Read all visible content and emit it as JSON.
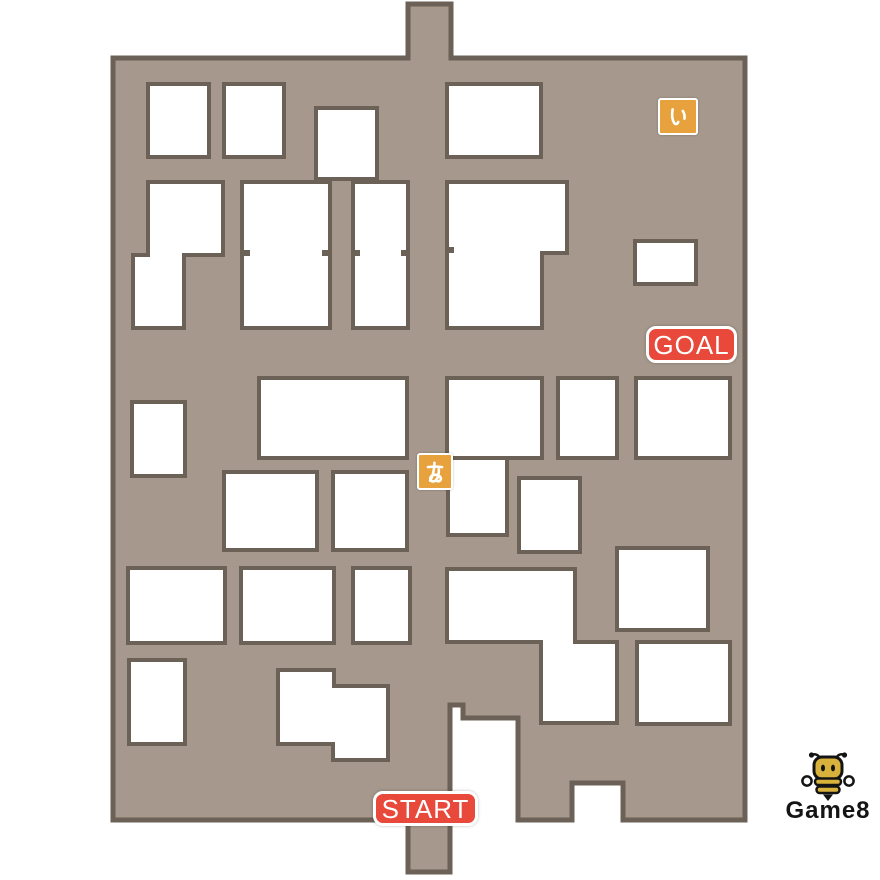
{
  "map": {
    "colors": {
      "ground": "#a6988c",
      "outline": "#6b6156",
      "building": "#ffffff",
      "background": "#ffffff"
    },
    "outer_stroke": 5,
    "building_stroke": 4,
    "outer_outline": "113,58 408,58 408,4 451,4 451,58 745,58 745,820 623,820 623,783 572,783 572,820 518,820 518,718 463,718 463,705 450,705 450,872 408,872 408,820 113,820",
    "buildings": [
      {
        "x": 148,
        "y": 84,
        "w": 61,
        "h": 73
      },
      {
        "x": 224,
        "y": 84,
        "w": 60,
        "h": 73
      },
      {
        "x": 316,
        "y": 108,
        "w": 61,
        "h": 71
      },
      {
        "x": 447,
        "y": 84,
        "w": 94,
        "h": 73
      },
      {
        "points": "148,182 223,182 223,255 184,255 184,328 133,328 133,255 148,255"
      },
      {
        "x": 242,
        "y": 182,
        "w": 88,
        "h": 146
      },
      {
        "x": 353,
        "y": 182,
        "w": 55,
        "h": 146
      },
      {
        "points": "447,182 567,182 567,253 542,253 542,328 447,328"
      },
      {
        "x": 635,
        "y": 241,
        "w": 61,
        "h": 43
      },
      {
        "x": 132,
        "y": 402,
        "w": 53,
        "h": 74
      },
      {
        "x": 259,
        "y": 378,
        "w": 148,
        "h": 80
      },
      {
        "x": 447,
        "y": 378,
        "w": 95,
        "h": 80
      },
      {
        "x": 558,
        "y": 378,
        "w": 59,
        "h": 80
      },
      {
        "x": 636,
        "y": 378,
        "w": 94,
        "h": 80
      },
      {
        "x": 448,
        "y": 458,
        "w": 59,
        "h": 77
      },
      {
        "x": 224,
        "y": 472,
        "w": 93,
        "h": 78
      },
      {
        "x": 333,
        "y": 472,
        "w": 74,
        "h": 78
      },
      {
        "x": 519,
        "y": 478,
        "w": 61,
        "h": 74
      },
      {
        "x": 617,
        "y": 548,
        "w": 91,
        "h": 82
      },
      {
        "x": 128,
        "y": 568,
        "w": 97,
        "h": 75
      },
      {
        "x": 241,
        "y": 568,
        "w": 93,
        "h": 75
      },
      {
        "x": 353,
        "y": 568,
        "w": 57,
        "h": 75
      },
      {
        "points": "447,569 575,569 575,642 617,642 617,723 541,723 541,642 447,642"
      },
      {
        "x": 129,
        "y": 660,
        "w": 56,
        "h": 84
      },
      {
        "points": "278,670 334,670 334,686 388,686 388,760 333,760 333,744 278,744"
      },
      {
        "x": 637,
        "y": 642,
        "w": 93,
        "h": 82
      }
    ],
    "seam_marks": [
      {
        "x": 244,
        "y": 250,
        "w": 6,
        "h": 6
      },
      {
        "x": 322,
        "y": 250,
        "w": 6,
        "h": 6
      },
      {
        "x": 355,
        "y": 250,
        "w": 5,
        "h": 6
      },
      {
        "x": 401,
        "y": 250,
        "w": 5,
        "h": 6
      },
      {
        "x": 449,
        "y": 247,
        "w": 5,
        "h": 6
      }
    ]
  },
  "markers": {
    "start": {
      "label": "START",
      "x": 373,
      "y": 791,
      "w": 105,
      "h": 35,
      "color": "#e8493b"
    },
    "goal": {
      "label": "GOAL",
      "x": 646,
      "y": 326,
      "w": 91,
      "h": 37,
      "color": "#e8493b"
    },
    "a": {
      "label": "あ",
      "x": 417,
      "y": 453,
      "w": 36,
      "h": 37,
      "color": "#e8a23d"
    },
    "i": {
      "label": "い",
      "x": 658,
      "y": 98,
      "w": 40,
      "h": 37,
      "color": "#e8a23d"
    }
  },
  "logo": {
    "text": "Game8"
  }
}
